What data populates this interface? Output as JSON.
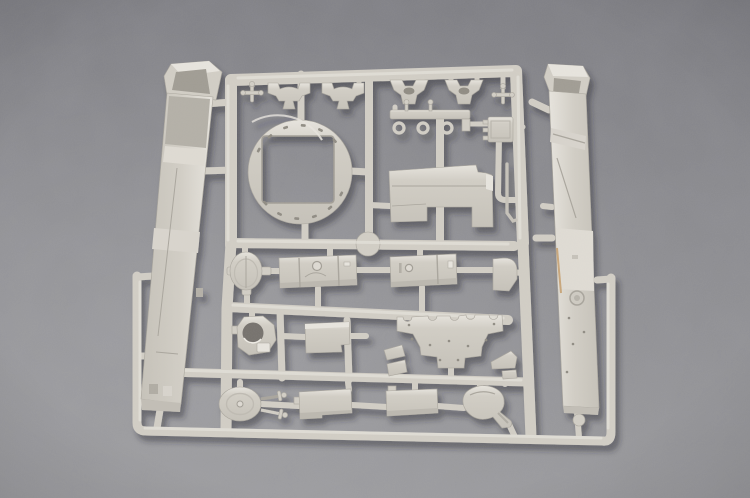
{
  "scene": {
    "description": "Overhead photograph of a single light-grey injection-moulded plastic sprue (runner frame) of scale model tank parts lying on a grey textured surface",
    "surface": "grey mottled fabric-like backdrop",
    "sprue": {
      "material": "polystyrene plastic",
      "color_name": "light warm grey",
      "parts_total": 26
    },
    "parts": [
      {
        "id": "left-hull-side",
        "label": "tall left hull side panel standing on edge"
      },
      {
        "id": "right-hull-side",
        "label": "tall right hull side panel standing on edge"
      },
      {
        "id": "turret-ring",
        "label": "large circular turret ring with square opening and bolt marks"
      },
      {
        "id": "valve-handle-left",
        "label": "small cross-shaped valve handle part"
      },
      {
        "id": "bracket-small-1",
        "label": "small saddle mounting bracket"
      },
      {
        "id": "bracket-small-2",
        "label": "small saddle mounting bracket"
      },
      {
        "id": "bracket-large-1",
        "label": "large notched mounting bracket"
      },
      {
        "id": "bracket-large-2",
        "label": "large notched mounting bracket"
      },
      {
        "id": "valve-handle-right",
        "label": "small cross-shaped valve handle part"
      },
      {
        "id": "hook-rail",
        "label": "rail part with three hanging loop hooks"
      },
      {
        "id": "radiator-box",
        "label": "small box part with side tabs"
      },
      {
        "id": "engine-deck-plate",
        "label": "large flat stepped engine deck plate"
      },
      {
        "id": "thin-rod",
        "label": "thin bent rod part"
      },
      {
        "id": "oval-cover",
        "label": "oval access cover with side lugs"
      },
      {
        "id": "fuel-tank-1",
        "label": "cylindrical stowage tank with filler cap"
      },
      {
        "id": "fuel-tank-2",
        "label": "cylindrical stowage tank with latch detail"
      },
      {
        "id": "corner-wedge",
        "label": "quarter-round corner fairing"
      },
      {
        "id": "hatch-ring",
        "label": "hatch base ring with large round opening"
      },
      {
        "id": "equipment-box",
        "label": "small stepped equipment box"
      },
      {
        "id": "notched-mount-plate",
        "label": "wide castellated mounting plate with scalloped top edge"
      },
      {
        "id": "wedge-pair-left",
        "label": "pair of small angled wedge brackets"
      },
      {
        "id": "wedge-right",
        "label": "angled wedge bracket"
      },
      {
        "id": "round-hatch",
        "label": "round hatch lid with two T-handles"
      },
      {
        "id": "stowage-box-1",
        "label": "rectangular stowage box"
      },
      {
        "id": "stowage-box-2",
        "label": "rectangular stowage box"
      },
      {
        "id": "blower-housing",
        "label": "rounded blower housing with angled spout"
      }
    ]
  },
  "colors": {
    "bg_top": "#7d7d82",
    "bg_mid": "#8a8a8e",
    "bg_bottom": "#98989b",
    "plastic_light": "#e8e5de",
    "plastic_base": "#d2cec5",
    "plastic_mid": "#c6c2b9",
    "plastic_dark": "#a9a59c",
    "plastic_deep": "#8f8b82",
    "interior_shadow": "#a09c93",
    "glint_warm": "#c49c6a",
    "cast_shadow": "#26262c"
  }
}
